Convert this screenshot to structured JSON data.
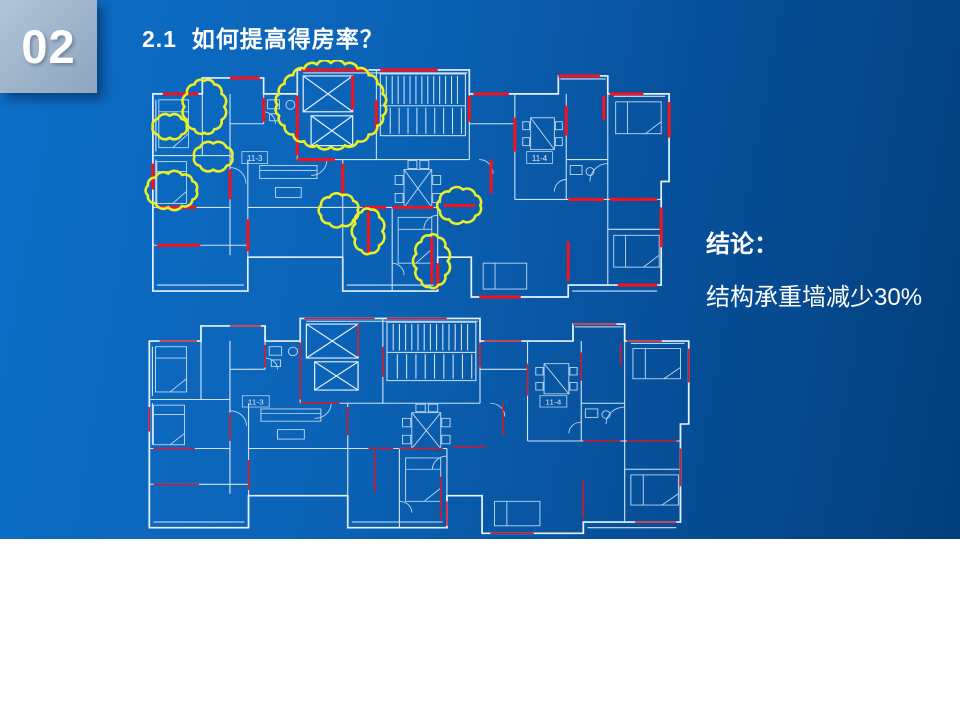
{
  "slide": {
    "chapter_number": "02",
    "title": "2.1  如何提高得房率？",
    "conclusion": {
      "heading": "结论：",
      "body": "结构承重墙减少30%"
    },
    "floorplan": {
      "unit_labels": {
        "left": "11-3",
        "right": "11-4"
      }
    },
    "colors": {
      "background_start": "#0d6ec8",
      "background_end": "#033e7c",
      "blueprint_line": "#d8e9fa",
      "highlight_red": "#f31220",
      "cloud_yellow": "#eaf028",
      "chapter_box": "#9fb5cb"
    }
  }
}
